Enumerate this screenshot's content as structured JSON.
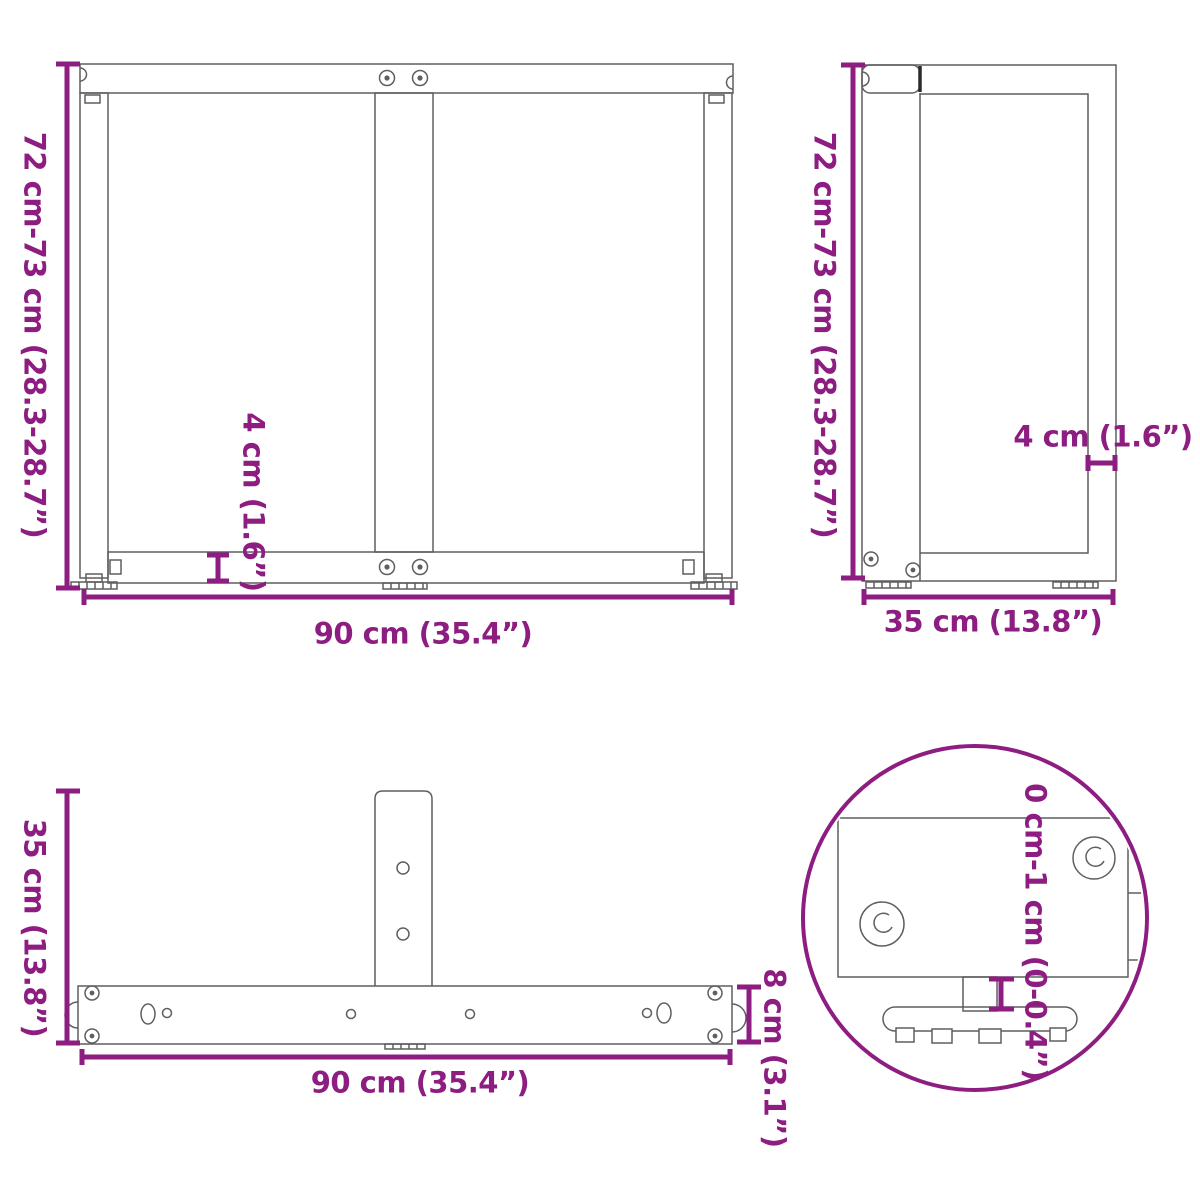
{
  "colors": {
    "accent": "#8D1D80",
    "line": "#5f5f5f",
    "dark_line": "#2a2a2a"
  },
  "views": {
    "front": {
      "title": "table-leg-front-view",
      "height_label": "72 cm-73 cm (28.3-28.7”)",
      "width_label": "90 cm (35.4”)",
      "rail_height_label": "4 cm (1.6”)"
    },
    "side": {
      "title": "table-leg-side-view",
      "height_label": "72 cm-73 cm (28.3-28.7”)",
      "width_label": "35 cm (13.8”)",
      "top_gap_label": "4 cm (1.6”)"
    },
    "top": {
      "title": "table-leg-top-view",
      "depth_label": "35 cm (13.8”)",
      "width_label": "90 cm (35.4”)",
      "bar_width_label": "8 cm (3.1”)"
    },
    "detail": {
      "title": "adjustable-foot-detail",
      "foot_adjustment_label": "0 cm-1 cm (0-0.4”)"
    }
  }
}
